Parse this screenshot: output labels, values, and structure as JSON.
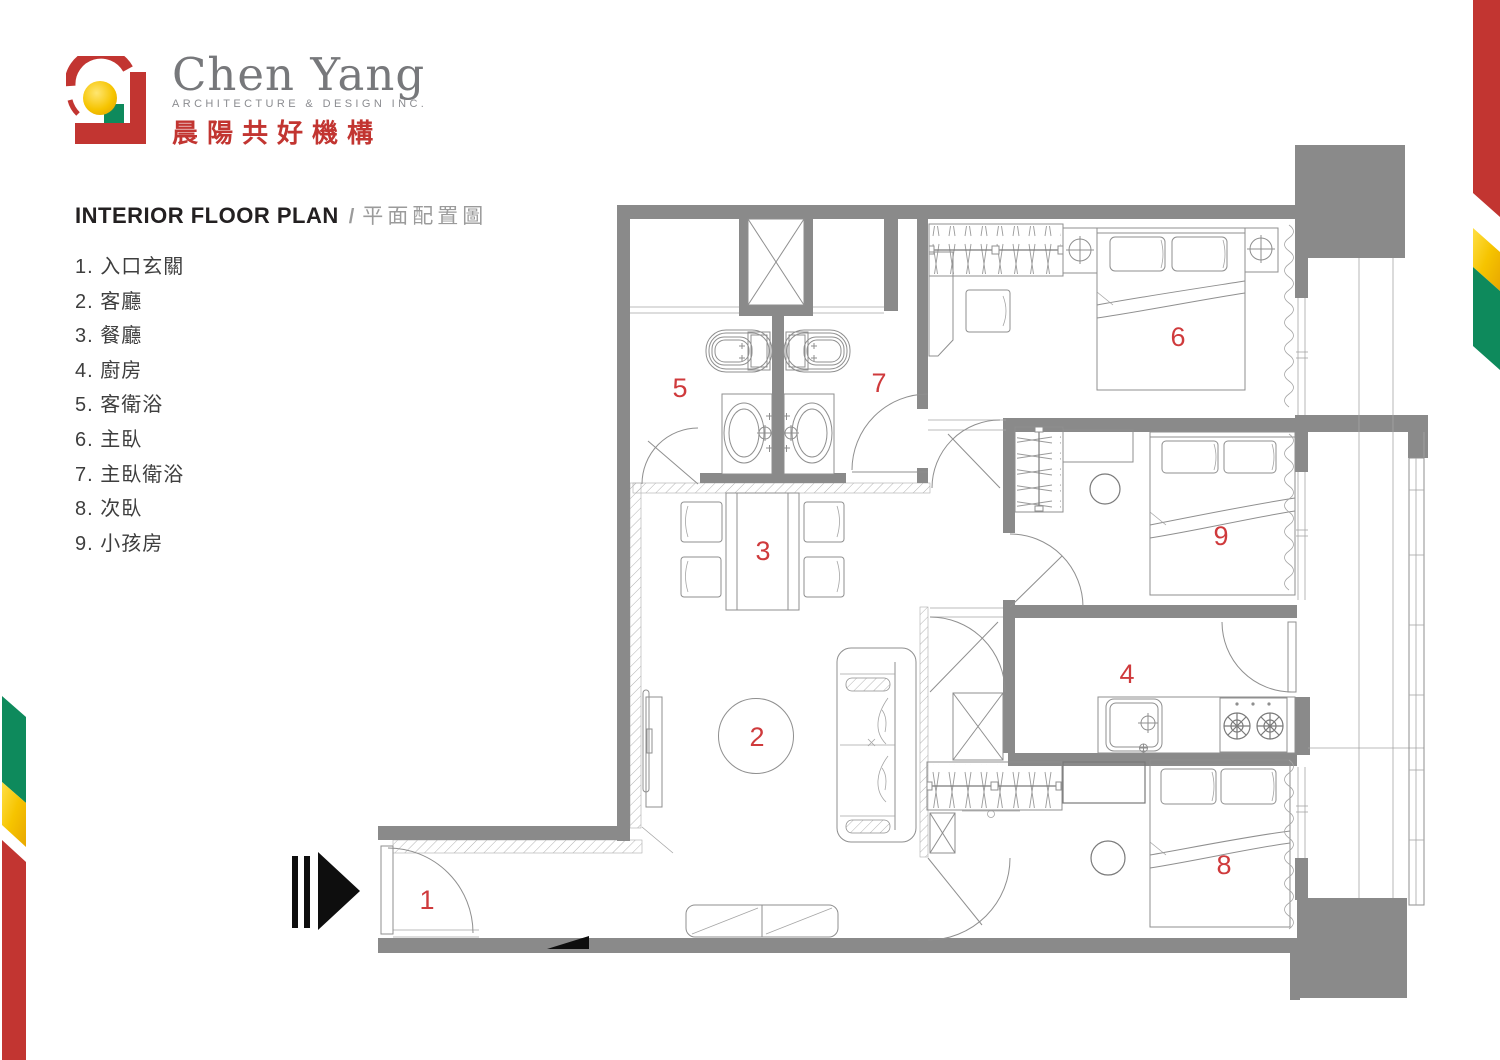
{
  "brand": {
    "name_en": "Chen Yang",
    "tagline": "ARCHITECTURE & DESIGN INC.",
    "name_zh": "晨陽共好機構"
  },
  "title": {
    "en": "INTERIOR FLOOR PLAN",
    "sep": "/",
    "zh": "平面配置圖"
  },
  "legend": {
    "items": [
      {
        "num": "1",
        "label": "入口玄關"
      },
      {
        "num": "2",
        "label": "客廳"
      },
      {
        "num": "3",
        "label": "餐廳"
      },
      {
        "num": "4",
        "label": "廚房"
      },
      {
        "num": "5",
        "label": "客衛浴"
      },
      {
        "num": "6",
        "label": "主臥"
      },
      {
        "num": "7",
        "label": "主臥衛浴"
      },
      {
        "num": "8",
        "label": "次臥"
      },
      {
        "num": "9",
        "label": "小孩房"
      }
    ]
  },
  "plan": {
    "room_labels": [
      {
        "num": "1",
        "x": 427,
        "y": 900
      },
      {
        "num": "2",
        "x": 757,
        "y": 737
      },
      {
        "num": "3",
        "x": 763,
        "y": 551
      },
      {
        "num": "4",
        "x": 1127,
        "y": 674
      },
      {
        "num": "5",
        "x": 680,
        "y": 388
      },
      {
        "num": "6",
        "x": 1178,
        "y": 337
      },
      {
        "num": "7",
        "x": 879,
        "y": 383
      },
      {
        "num": "8",
        "x": 1224,
        "y": 865
      },
      {
        "num": "9",
        "x": 1221,
        "y": 536
      }
    ]
  },
  "colors": {
    "wall": "#8a8a8a",
    "furniture_line": "#8f8f8f",
    "room_number": "#cf3a3c",
    "brand_red": "#c23531",
    "brand_yellow": "#f6c400",
    "brand_green": "#0e8a5c",
    "brand_gray": "#77787b",
    "title_dark": "#232021",
    "title_gray": "#9b9b9b"
  }
}
